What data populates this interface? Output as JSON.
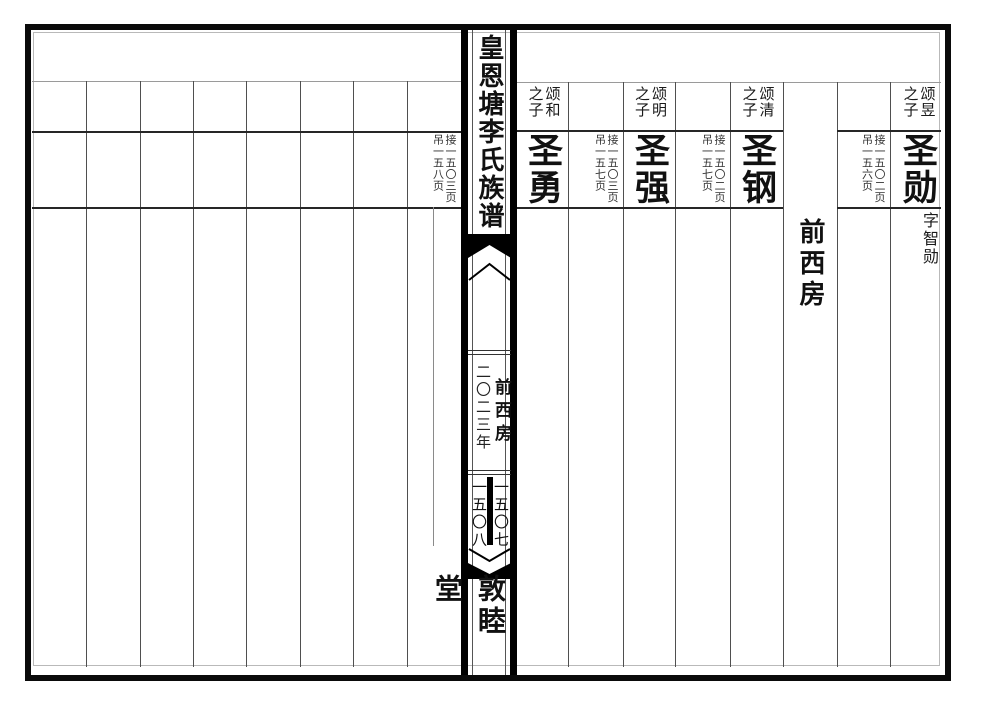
{
  "colors": {
    "ink": "#111111",
    "grid_line": "#4f4f4f",
    "row_line": "#262626",
    "bar": "#000000"
  },
  "spine": {
    "title": "皇恩塘李氏族谱",
    "section_label": "前西房",
    "year": "二〇二三年",
    "page_number_right": "一五〇七",
    "page_number_left": "一五〇八",
    "hall_name": "敦睦堂"
  },
  "right_page": {
    "branch_label": "前西房",
    "persons": [
      {
        "parent": "颂和",
        "relation": "之子",
        "name": "圣勇",
        "continued_from": "接一五〇三页",
        "cross_ref": "吊一五八页"
      },
      {
        "parent": "颂明",
        "relation": "之子",
        "name": "圣强",
        "continued_from": "接一五〇三页",
        "cross_ref": "吊一五七页"
      },
      {
        "parent": "颂清",
        "relation": "之子",
        "name": "圣钢",
        "continued_from": "接一五〇二页",
        "cross_ref": "吊一五七页"
      },
      {
        "parent": "颂昱",
        "relation": "之子",
        "name": "圣勋",
        "courtesy_name": "字智勋",
        "continued_from": "接一五〇二页",
        "cross_ref": "吊一五六页"
      }
    ]
  }
}
